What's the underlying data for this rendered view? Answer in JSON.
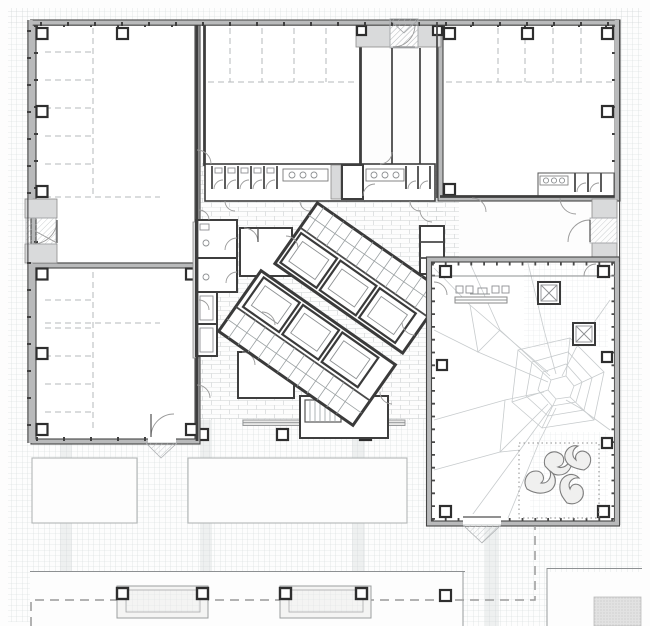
{
  "document": {
    "kind": "architectural-floor-plan",
    "aria_label": "Ground floor plan drawing of a museum-type building with four exhibition halls, central diagonal stair-and-elevator core, sanitary block, glazed gallery wing with sculptural floor, and exterior plaza with benches",
    "title_tooltip": "Ground floor plan"
  },
  "colors": {
    "background": "#fdfdfd",
    "grid_line": "#d3d8da",
    "brick_line": "#cdd1d2",
    "wall_dark": "#3e3e3e",
    "facade_band": "#b9babb",
    "pier_fill": "#d9dadb",
    "rack_dash": "#b6b9bb",
    "property_dash": "#9a9a9a",
    "crack_line": "#c7cbcd",
    "sculpture_fill": "#f0f0ef"
  },
  "regions": [
    {
      "name": "hall-top-left",
      "type": "exhibition-hall"
    },
    {
      "name": "hall-top-center",
      "type": "exhibition-hall"
    },
    {
      "name": "hall-top-right",
      "type": "exhibition-hall"
    },
    {
      "name": "hall-bottom-left",
      "type": "exhibition-hall"
    },
    {
      "name": "central-core",
      "type": "stairs-elevators"
    },
    {
      "name": "sanitary-strip",
      "type": "toilets"
    },
    {
      "name": "gallery-wing",
      "type": "glazed-gallery"
    },
    {
      "name": "plaza",
      "type": "exterior-paving"
    },
    {
      "name": "bench-row",
      "type": "street-furniture"
    }
  ],
  "counts": {
    "plaza_canopies": 2,
    "benches": 2,
    "skylight_squares": 2,
    "core_blocks": 2
  }
}
